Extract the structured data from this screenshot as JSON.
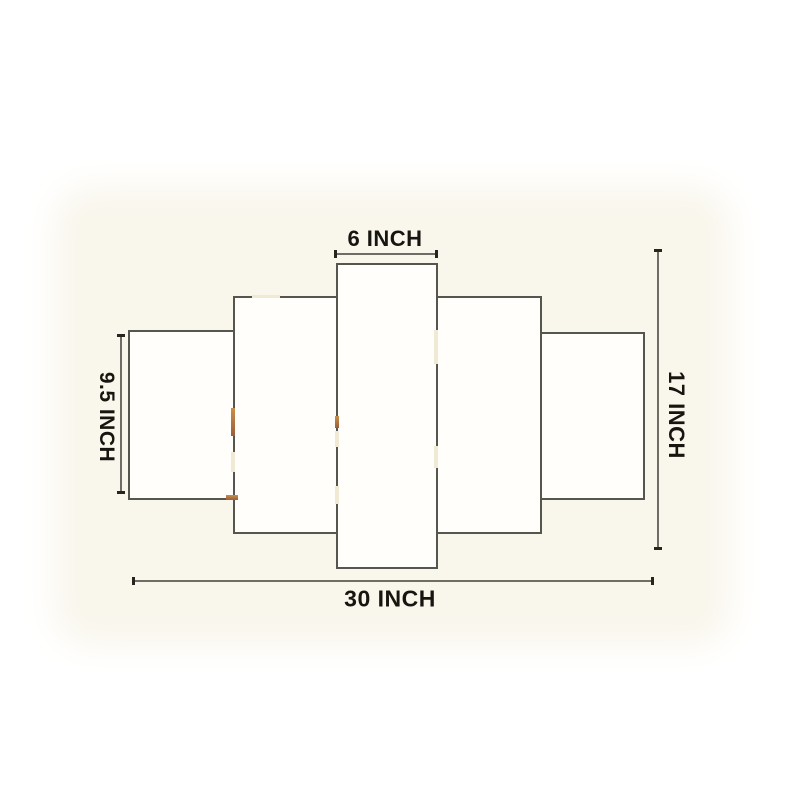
{
  "diagram": {
    "subject": "5-panel wall art set dimension diagram",
    "panel_count": 5,
    "labels": {
      "top": "6 INCH",
      "left": "9.5 INCH",
      "right": "17 INCH",
      "bottom": "30 INCH"
    },
    "measurements": {
      "center_panel_width": "6 INCH",
      "outer_panel_height": "9.5 INCH",
      "total_height": "17 INCH",
      "total_width": "30 INCH"
    }
  },
  "colors": {
    "background": "#ffffff",
    "backdrop_cream": "#f9f6ec",
    "panel_fill": "#fffefb",
    "panel_border": "#56554e",
    "dimension_line": "#6e6d66",
    "tick": "#26251f",
    "label_text": "#16150f",
    "glint_gold": "#c98f4a",
    "glint_light": "#f0e9d3"
  }
}
